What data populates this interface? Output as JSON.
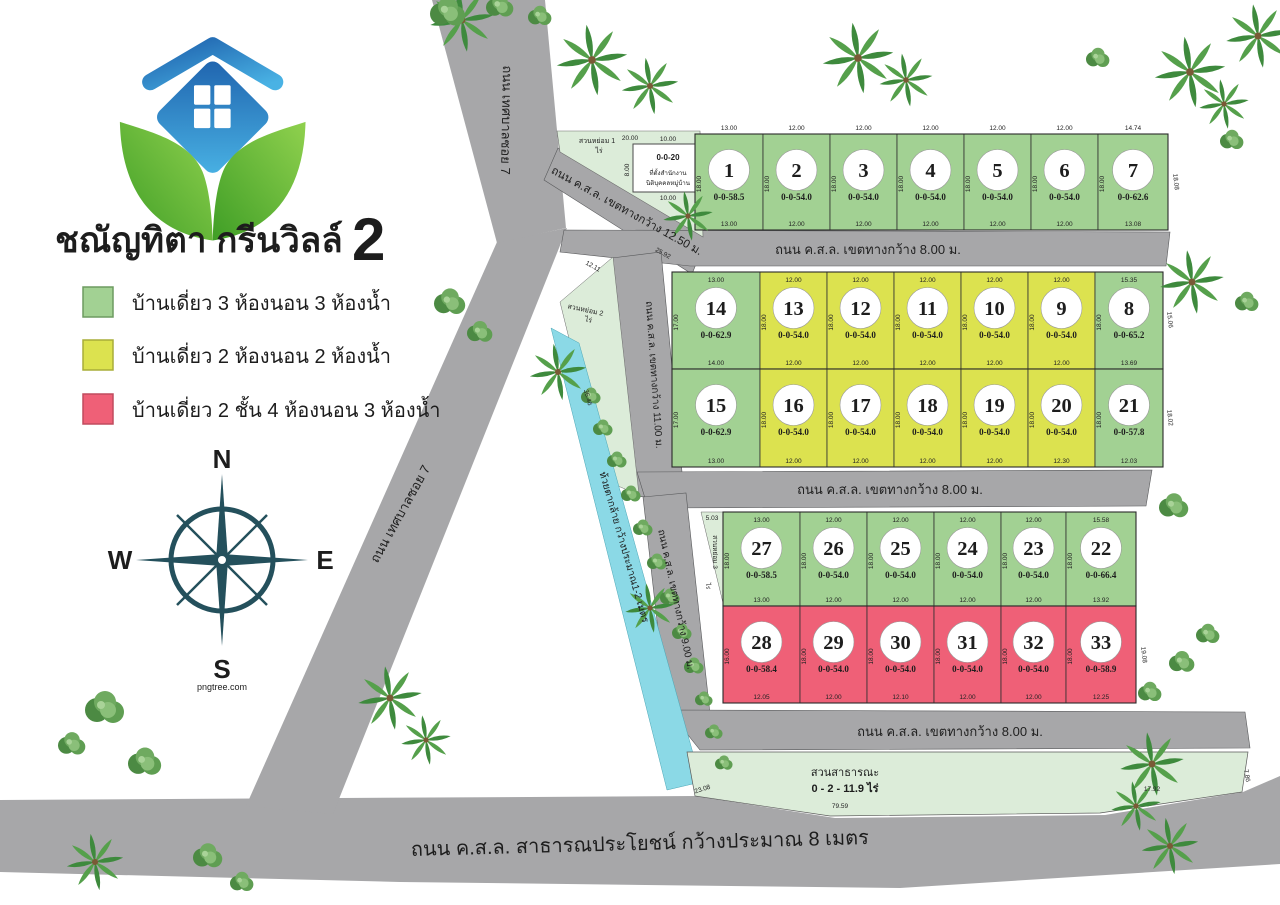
{
  "branding": {
    "title": "ชณัญทิตา กรีนวิลล์",
    "title_no": "2",
    "watermark": "pngtree.com"
  },
  "legend": {
    "items": [
      {
        "label": "บ้านเดี่ยว 3 ห้องนอน 3 ห้องน้ำ",
        "color": "#a2d193",
        "type": "green"
      },
      {
        "label": "บ้านเดี่ยว 2 ห้องนอน 2 ห้องน้ำ",
        "color": "#dce24f",
        "type": "yellow"
      },
      {
        "label": "บ้านเดี่ยว 2 ชั้น  4 ห้องนอน 3 ห้องน้ำ",
        "color": "#ef6077",
        "type": "pink"
      }
    ]
  },
  "compass": {
    "n": "N",
    "e": "E",
    "s": "S",
    "w": "W"
  },
  "colors": {
    "green": "#a2d193",
    "yellow": "#dce24f",
    "pink": "#ef6077",
    "park": "#dcecd9",
    "creek": "#8bd9e6",
    "road": "#a7a7a9"
  },
  "roads": {
    "soi7": "ถนน เทศบาลซอย 7",
    "entry": "ถนน ค.ส.ล. เขตทางกว้าง 12.50 ม.",
    "w8": "ถนน ค.ส.ล. เขตทางกว้าง 8.00 ม.",
    "w11": "ถนน ค.ส.ล. เขตทางกว้าง 11.00 ม.",
    "w9": "ถนน ค.ส.ล. เขตทางกว้าง 9.00 ม.",
    "public": "ถนน ค.ส.ล. สาธารณประโยชน์ กว้างประมาณ 8 เมตร"
  },
  "creek": {
    "label": "ห้วยตากล้าย กว้างประมาณ1-2 เมตร"
  },
  "parks": {
    "g1": {
      "label": "สวนหย่อม 1",
      "dim": "20.00",
      "rai": "ไร่"
    },
    "g2": {
      "label": "สวนหย่อม 2",
      "rai": "ไร่"
    },
    "g3": {
      "label": "สวนหย่อม 3",
      "rai": "ไร่"
    },
    "public": {
      "line1": "สวนสาธารณะ",
      "line2": "0 - 2 - 11.9  ไร่"
    }
  },
  "office": {
    "area": "0-0-20",
    "line1": "ที่ตั้งสำนักงาน",
    "line2": "นิติบุคคลหมู่บ้าน",
    "top": "10.00",
    "bottom": "10.00",
    "left": "8.00",
    "right": "8.00"
  },
  "dims": {
    "entry_a": "25.92",
    "entry_b": "12.11",
    "creek": "36.46",
    "g3": "5.03",
    "park_bottom": "79.59",
    "park_left": "23.08",
    "park_right": "17.92",
    "park_side": "7.86",
    "r1": "18.08",
    "r2": "15.06",
    "r3": "18.02",
    "r5": "19.08"
  },
  "plot_rows": [
    {
      "plots": [
        {
          "no": "1",
          "area": "0-0-58.5",
          "type": "green",
          "top": "13.00",
          "bottom": "13.00",
          "side": "18.00"
        },
        {
          "no": "2",
          "area": "0-0-54.0",
          "type": "green",
          "top": "12.00",
          "bottom": "12.00",
          "side": "18.00"
        },
        {
          "no": "3",
          "area": "0-0-54.0",
          "type": "green",
          "top": "12.00",
          "bottom": "12.00",
          "side": "18.00"
        },
        {
          "no": "4",
          "area": "0-0-54.0",
          "type": "green",
          "top": "12.00",
          "bottom": "12.00",
          "side": "18.00"
        },
        {
          "no": "5",
          "area": "0-0-54.0",
          "type": "green",
          "top": "12.00",
          "bottom": "12.00",
          "side": "18.00"
        },
        {
          "no": "6",
          "area": "0-0-54.0",
          "type": "green",
          "top": "12.00",
          "bottom": "12.00",
          "side": "18.00"
        },
        {
          "no": "7",
          "area": "0-0-62.6",
          "type": "green",
          "top": "14.74",
          "bottom": "13.08",
          "side": "18.00"
        }
      ]
    },
    {
      "plots": [
        {
          "no": "14",
          "area": "0-0-62.9",
          "type": "green",
          "top": "13.00",
          "bottom": "14.00",
          "side": "17.00"
        },
        {
          "no": "13",
          "area": "0-0-54.0",
          "type": "yellow",
          "top": "12.00",
          "bottom": "12.00",
          "side": "18.00"
        },
        {
          "no": "12",
          "area": "0-0-54.0",
          "type": "yellow",
          "top": "12.00",
          "bottom": "12.00",
          "side": "18.00"
        },
        {
          "no": "11",
          "area": "0-0-54.0",
          "type": "yellow",
          "top": "12.00",
          "bottom": "12.00",
          "side": "18.00"
        },
        {
          "no": "10",
          "area": "0-0-54.0",
          "type": "yellow",
          "top": "12.00",
          "bottom": "12.00",
          "side": "18.00"
        },
        {
          "no": "9",
          "area": "0-0-54.0",
          "type": "yellow",
          "top": "12.00",
          "bottom": "12.00",
          "side": "18.00"
        },
        {
          "no": "8",
          "area": "0-0-65.2",
          "type": "green",
          "top": "15.35",
          "bottom": "13.69",
          "side": "18.00"
        }
      ]
    },
    {
      "plots": [
        {
          "no": "15",
          "area": "0-0-62.9",
          "type": "green",
          "top": "",
          "bottom": "13.00",
          "side": "17.00"
        },
        {
          "no": "16",
          "area": "0-0-54.0",
          "type": "yellow",
          "top": "",
          "bottom": "12.00",
          "side": "18.00"
        },
        {
          "no": "17",
          "area": "0-0-54.0",
          "type": "yellow",
          "top": "",
          "bottom": "12.00",
          "side": "18.00"
        },
        {
          "no": "18",
          "area": "0-0-54.0",
          "type": "yellow",
          "top": "",
          "bottom": "12.00",
          "side": "18.00"
        },
        {
          "no": "19",
          "area": "0-0-54.0",
          "type": "yellow",
          "top": "",
          "bottom": "12.00",
          "side": "18.00"
        },
        {
          "no": "20",
          "area": "0-0-54.0",
          "type": "yellow",
          "top": "",
          "bottom": "12.30",
          "side": "18.00"
        },
        {
          "no": "21",
          "area": "0-0-57.8",
          "type": "green",
          "top": "",
          "bottom": "12.03",
          "side": "18.00"
        }
      ]
    },
    {
      "plots": [
        {
          "no": "27",
          "area": "0-0-58.5",
          "type": "green",
          "top": "13.00",
          "bottom": "13.00",
          "side": "18.00"
        },
        {
          "no": "26",
          "area": "0-0-54.0",
          "type": "green",
          "top": "12.00",
          "bottom": "12.00",
          "side": "18.00"
        },
        {
          "no": "25",
          "area": "0-0-54.0",
          "type": "green",
          "top": "12.00",
          "bottom": "12.00",
          "side": "18.00"
        },
        {
          "no": "24",
          "area": "0-0-54.0",
          "type": "green",
          "top": "12.00",
          "bottom": "12.00",
          "side": "18.00"
        },
        {
          "no": "23",
          "area": "0-0-54.0",
          "type": "green",
          "top": "12.00",
          "bottom": "12.00",
          "side": "18.00"
        },
        {
          "no": "22",
          "area": "0-0-66.4",
          "type": "green",
          "top": "15.58",
          "bottom": "13.92",
          "side": "18.00"
        }
      ]
    },
    {
      "plots": [
        {
          "no": "28",
          "area": "0-0-58.4",
          "type": "pink",
          "top": "",
          "bottom": "12.05",
          "side": "16.00"
        },
        {
          "no": "29",
          "area": "0-0-54.0",
          "type": "pink",
          "top": "",
          "bottom": "12.00",
          "side": "18.00"
        },
        {
          "no": "30",
          "area": "0-0-54.0",
          "type": "pink",
          "top": "",
          "bottom": "12.10",
          "side": "18.00"
        },
        {
          "no": "31",
          "area": "0-0-54.0",
          "type": "pink",
          "top": "",
          "bottom": "12.00",
          "side": "18.00"
        },
        {
          "no": "32",
          "area": "0-0-54.0",
          "type": "pink",
          "top": "",
          "bottom": "12.00",
          "side": "18.00"
        },
        {
          "no": "33",
          "area": "0-0-58.9",
          "type": "pink",
          "top": "",
          "bottom": "12.25",
          "side": "18.00"
        }
      ]
    }
  ]
}
